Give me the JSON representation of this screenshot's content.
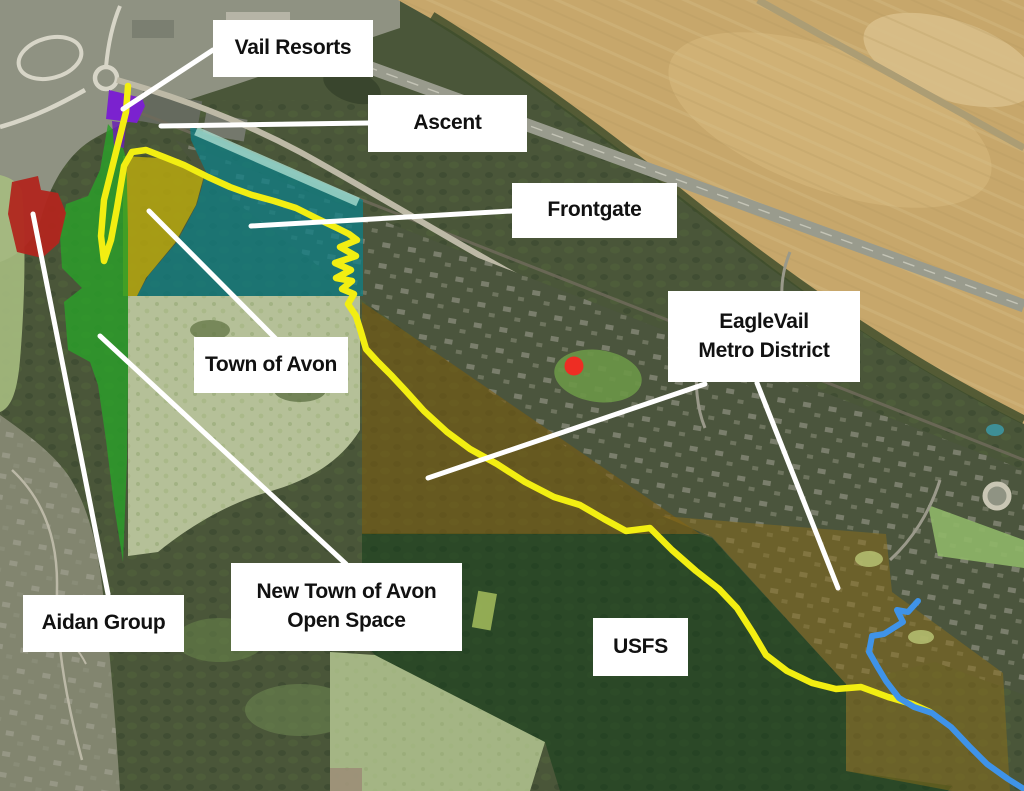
{
  "labels": {
    "vail_resorts": "Vail Resorts",
    "ascent": "Ascent",
    "frontgate": "Frontgate",
    "eaglevail_line1": "EagleVail",
    "eaglevail_line2": "Metro District",
    "town_of_avon": "Town of Avon",
    "new_town_line1": "New Town of Avon",
    "new_town_line2": "Open Space",
    "aidan_group": "Aidan Group",
    "usfs": "USFS"
  },
  "colors": {
    "label_background": "#ffffff",
    "label_text": "#111111",
    "leader_line": "#ffffff",
    "vail_resorts_parcel": "#7b22cf",
    "aidan_group_parcel": "#b1261e",
    "town_of_avon_parcel": "#b6a70f",
    "frontgate_parcel": "#0d7f86",
    "open_space_parcel": "#2ba02a",
    "eaglevail_parcel_west": "#7a5c10",
    "eaglevail_parcel_east": "#8a6d1a",
    "usfs_parcel": "#0b3a15",
    "trail": "#f2ee12",
    "creek": "#3f93e8",
    "marker_dot": "#ee2d23"
  }
}
